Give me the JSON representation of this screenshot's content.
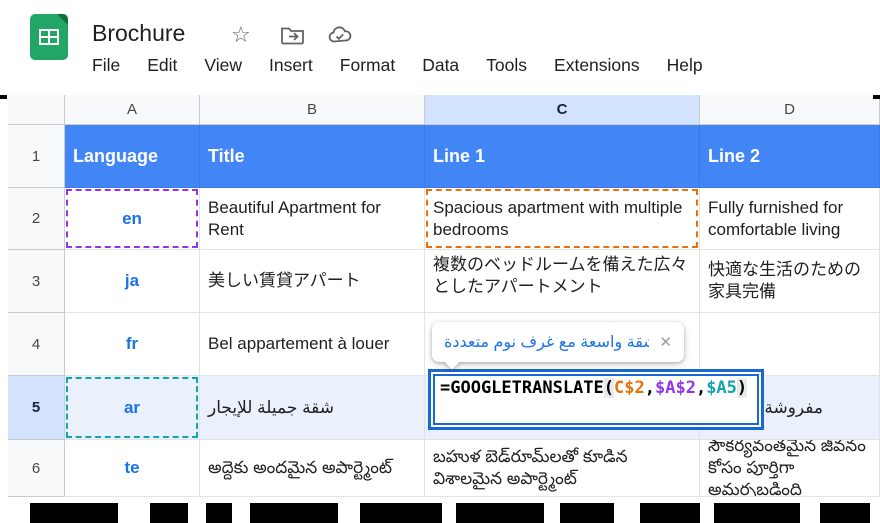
{
  "app": {
    "title": "Brochure",
    "star_icon": "☆",
    "menu": [
      "File",
      "Edit",
      "View",
      "Insert",
      "Format",
      "Data",
      "Tools",
      "Extensions",
      "Help"
    ]
  },
  "grid": {
    "column_letters": [
      "A",
      "B",
      "C",
      "D"
    ],
    "selected_column": "C",
    "row_numbers": [
      "1",
      "2",
      "3",
      "4",
      "5",
      "6"
    ],
    "selected_row": "5",
    "header_row": [
      "Language",
      "Title",
      "Line 1",
      "Line 2"
    ],
    "rows": [
      {
        "lang": "en",
        "title": "Beautiful Apartment for Rent",
        "line1": "Spacious apartment with multiple bedrooms",
        "line2": "Fully furnished for comfortable living"
      },
      {
        "lang": "ja",
        "title": "美しい賃貸アパート",
        "line1": "複数のベッドルームを備えた広々としたアパートメント",
        "line2": "快適な生活のための家具完備"
      },
      {
        "lang": "fr",
        "title": "Bel appartement à louer",
        "line1": "",
        "line2": ""
      },
      {
        "lang": "ar",
        "title": "شقة جميلة للإيجار",
        "line1": "",
        "line2": "مفروشة بالكامل"
      },
      {
        "lang": "te",
        "title": "అద్దెకు అందమైన అపార్ట్మెంట్",
        "line1": "బహుళ బెడ్‌రూమ్‌లతో కూడిన విశాలమైన అపార్ట్మెంట్",
        "line2": "సౌకర్యవంతమైన జీవనం కోసం పూర్తిగా అమర్చబడింది"
      }
    ]
  },
  "formula": {
    "full_text": "=GOOGLETRANSLATE(C$2,$A$2,$A5)",
    "tokens": [
      {
        "text": "=GOOGLETRANSLATE",
        "color": "#000000"
      },
      {
        "text": "(",
        "color": "#000000"
      },
      {
        "text": "C$2",
        "color": "#E8710A"
      },
      {
        "text": ",",
        "color": "#000000"
      },
      {
        "text": "$A$2",
        "color": "#9334E6"
      },
      {
        "text": ",",
        "color": "#000000"
      },
      {
        "text": "$A5",
        "color": "#12A4AF"
      },
      {
        "text": ")",
        "color": "#000000"
      }
    ]
  },
  "tooltip": {
    "text": "شقة واسعة مع غرف نوم متعددة",
    "close_label": "✕"
  },
  "colors": {
    "header_row_bg": "#4285F4",
    "lang_link_blue": "#1A73E8",
    "ref_orange": "#E8710A",
    "ref_purple": "#9334E6",
    "ref_teal": "#12A4AF",
    "selected_header_bg": "#D3E3FD",
    "editor_border_blue": "#1967D2",
    "tooltip_text_blue": "#1A73E8"
  }
}
